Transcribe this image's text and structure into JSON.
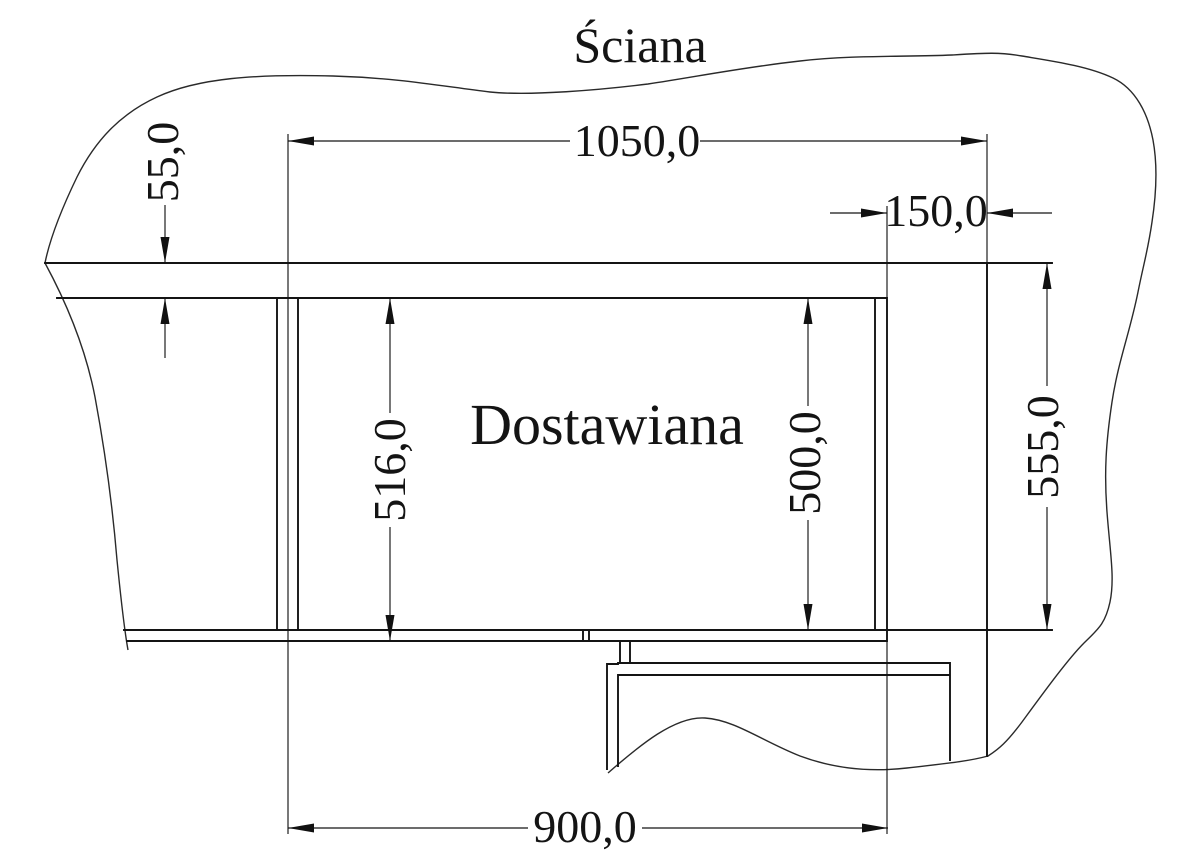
{
  "drawing": {
    "type": "technical-dimension-drawing",
    "wall_label": "Ściana",
    "cabinet_label": "Dostawiana",
    "dimensions": {
      "top_width": "1050,0",
      "right_niche_width": "150,0",
      "wall_to_cabinet_gap": "55,0",
      "cabinet_outer_depth": "516,0",
      "cabinet_inner_depth": "500,0",
      "wall_niche_depth": "555,0",
      "bottom_width": "900,0"
    },
    "colors": {
      "ink": "#141414",
      "background": "#ffffff",
      "hatch": "#2a2a2a"
    }
  }
}
